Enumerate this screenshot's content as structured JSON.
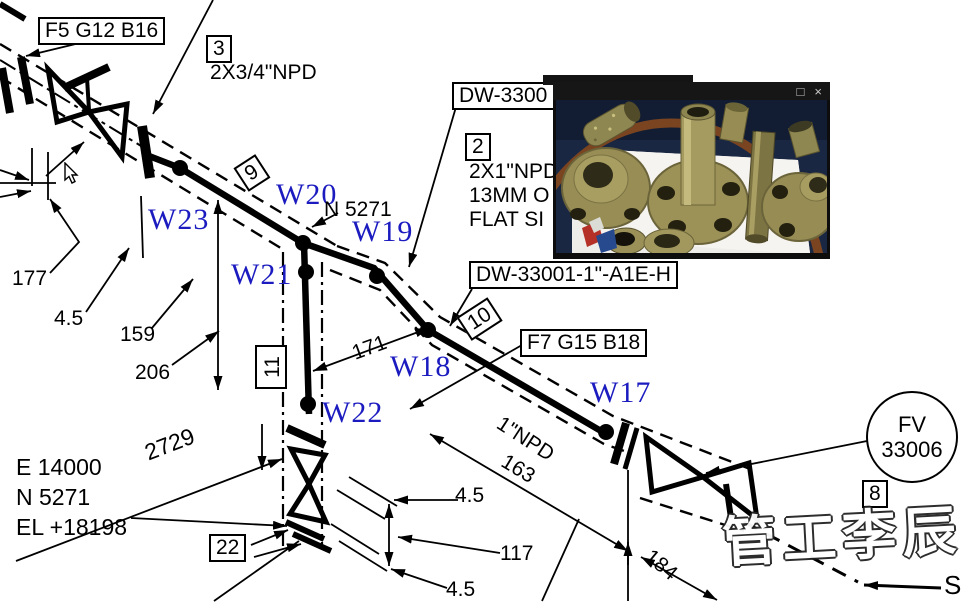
{
  "drawing": {
    "boxes": {
      "f5": "F5 G12 B16",
      "n3": "3",
      "npd34": "2X3/4\"NPD",
      "dw3300": "DW-3300",
      "n2": "2",
      "n2_line1": "2X1\"NPD",
      "n2_line2": "13MM O",
      "n2_line3": "FLAT SI",
      "dw33001": "DW-33001-1\"-A1E-H",
      "n9": "9",
      "n10": "10",
      "n11": "11",
      "f7": "F7 G15 B18",
      "n22": "22",
      "n8": "8"
    },
    "fv_tag": {
      "line1": "FV",
      "line2": "33006"
    },
    "welds": {
      "w17": "W17",
      "w18": "W18",
      "w19": "W19",
      "w20": "W20",
      "w21": "W21",
      "w22": "W22",
      "w23": "W23"
    },
    "north_ref": "N 5271",
    "dimensions": {
      "d177": "177",
      "d45a": "4.5",
      "d159": "159",
      "d206": "206",
      "d2729": "2729",
      "d171": "171",
      "d163": "163",
      "d117": "117",
      "d45b": "4.5",
      "d45c": "4.5",
      "d184": "184"
    },
    "pipe_size_label": "1\"NPD",
    "coordinates": {
      "east": "E 14000",
      "north": "N 5271",
      "elevation": "EL +18198"
    },
    "flow_label": "S"
  },
  "photo_window": {
    "maximize_icon": "□",
    "close_icon": "×"
  },
  "watermark": {
    "text": "管工李辰"
  },
  "colors": {
    "line": "#000000",
    "weld_label": "#1b1bc0",
    "photo_bg": "#1a2742",
    "brass": "#9a9058"
  }
}
